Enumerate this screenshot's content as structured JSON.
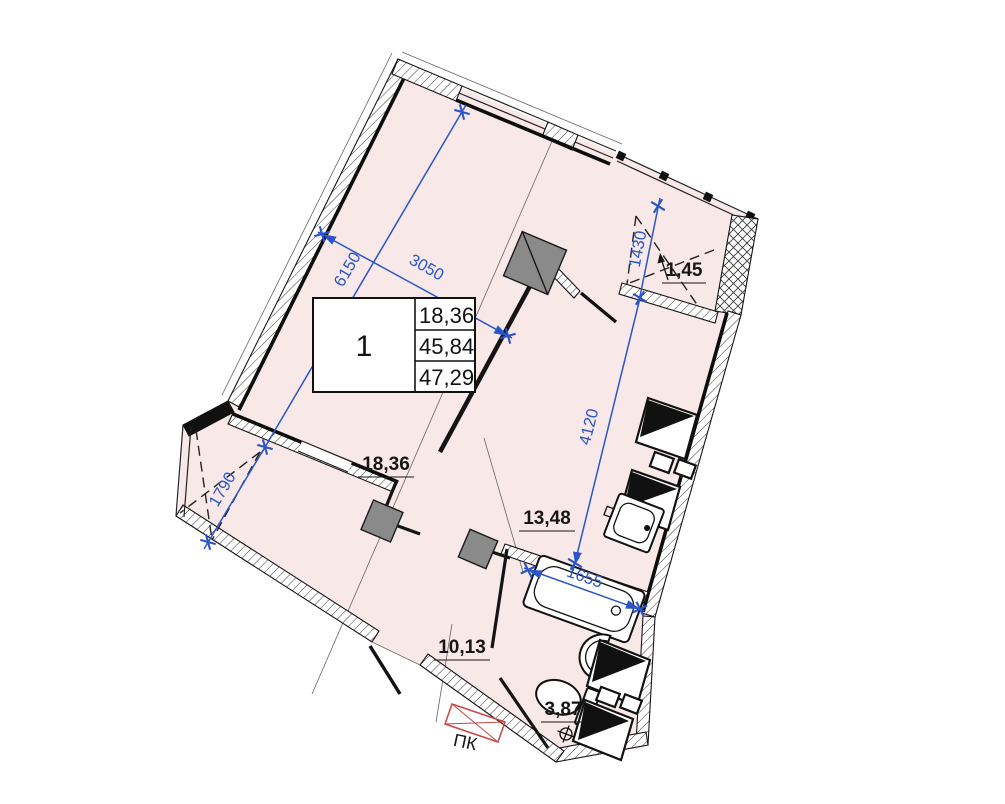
{
  "legend_table": {
    "apartment_number": "1",
    "rows": [
      {
        "name": "living-area",
        "value": "18,36"
      },
      {
        "name": "apartment-area",
        "value": "45,84"
      },
      {
        "name": "total-area",
        "value": "47,29"
      }
    ]
  },
  "dimensions": {
    "living_length": "6150",
    "living_width": "3050",
    "balcony_right_depth": "1430",
    "kitchen_length": "4120",
    "bathtub_length": "1655",
    "balcony_left_depth": "1790"
  },
  "room_areas": {
    "living": "18,36",
    "kitchen": "13,48",
    "hallway": "10,13",
    "bathroom": "3,87",
    "balcony": "1,45"
  },
  "annotations": {
    "convector": "ПК"
  },
  "colors": {
    "apartment_fill": "#f8e8e7",
    "dimension_blue": "#2a55c8",
    "convector_red": "#cc4444",
    "column_gray": "#8a8a8a",
    "wall_black": "#141414"
  }
}
